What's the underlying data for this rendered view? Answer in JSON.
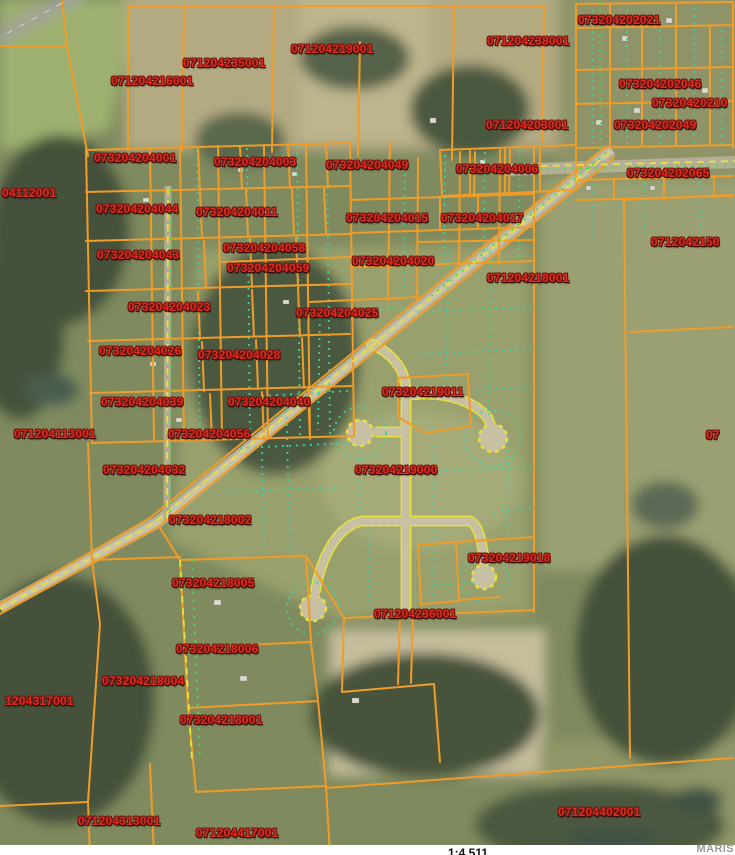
{
  "map": {
    "type": "gis-parcel-aerial-map",
    "scale_text": "1:4,511",
    "watermark": "MARIS",
    "colors": {
      "parcel_line": "#f09c28",
      "parcel_label": "#e12a1e",
      "road_centerline": "#e8e23a",
      "lot_line": "#3bd3a0",
      "street_dots": "#3fe04a",
      "scale_text": "#111111",
      "watermark": "#98989a"
    },
    "parcel_labels": [
      {
        "id": "073204202021",
        "x": 578,
        "y": 13
      },
      {
        "id": "071204238001",
        "x": 487,
        "y": 34
      },
      {
        "id": "071204219001",
        "x": 291,
        "y": 42
      },
      {
        "id": "071204235001",
        "x": 183,
        "y": 56
      },
      {
        "id": "071204216001",
        "x": 111,
        "y": 74
      },
      {
        "id": "073204202046",
        "x": 619,
        "y": 77
      },
      {
        "id": "07320420210",
        "x": 652,
        "y": 96
      },
      {
        "id": "071204203001",
        "x": 486,
        "y": 118
      },
      {
        "id": "073204202049",
        "x": 614,
        "y": 118
      },
      {
        "id": "073204204001",
        "x": 94,
        "y": 151
      },
      {
        "id": "073204204003",
        "x": 214,
        "y": 155
      },
      {
        "id": "073204204049",
        "x": 326,
        "y": 158
      },
      {
        "id": "073204204006",
        "x": 456,
        "y": 162
      },
      {
        "id": "073204202065",
        "x": 627,
        "y": 166
      },
      {
        "id": "04112001",
        "x": 2,
        "y": 186
      },
      {
        "id": "073204204044",
        "x": 96,
        "y": 202
      },
      {
        "id": "073204204011",
        "x": 196,
        "y": 205
      },
      {
        "id": "073204204015",
        "x": 346,
        "y": 211
      },
      {
        "id": "073204204017",
        "x": 441,
        "y": 211
      },
      {
        "id": "0712042150",
        "x": 651,
        "y": 235
      },
      {
        "id": "073204204058",
        "x": 223,
        "y": 241
      },
      {
        "id": "073204204043",
        "x": 97,
        "y": 248
      },
      {
        "id": "073204204020",
        "x": 352,
        "y": 254
      },
      {
        "id": "073204204059",
        "x": 227,
        "y": 261
      },
      {
        "id": "071204218001",
        "x": 487,
        "y": 271
      },
      {
        "id": "073204204023",
        "x": 128,
        "y": 300
      },
      {
        "id": "073204204025",
        "x": 296,
        "y": 306
      },
      {
        "id": "073204204026",
        "x": 99,
        "y": 344
      },
      {
        "id": "073204204028",
        "x": 198,
        "y": 348
      },
      {
        "id": "073204219011",
        "x": 382,
        "y": 385
      },
      {
        "id": "073204204039",
        "x": 101,
        "y": 395
      },
      {
        "id": "073204204040",
        "x": 228,
        "y": 395
      },
      {
        "id": "071204113001",
        "x": 14,
        "y": 427
      },
      {
        "id": "073204204056",
        "x": 168,
        "y": 427
      },
      {
        "id": "07",
        "x": 706,
        "y": 428
      },
      {
        "id": "073204204032",
        "x": 103,
        "y": 463
      },
      {
        "id": "073204219000",
        "x": 355,
        "y": 463
      },
      {
        "id": "073204218002",
        "x": 169,
        "y": 513
      },
      {
        "id": "073204219018",
        "x": 468,
        "y": 551
      },
      {
        "id": "073204218005",
        "x": 172,
        "y": 576
      },
      {
        "id": "071204236001",
        "x": 374,
        "y": 607
      },
      {
        "id": "073204218006",
        "x": 176,
        "y": 642
      },
      {
        "id": "073204218004",
        "x": 102,
        "y": 674
      },
      {
        "id": "1204317001",
        "x": 5,
        "y": 694
      },
      {
        "id": "073204218001",
        "x": 180,
        "y": 713
      },
      {
        "id": "071204402001",
        "x": 558,
        "y": 805
      },
      {
        "id": "071204313001",
        "x": 78,
        "y": 814
      },
      {
        "id": "071204417001",
        "x": 196,
        "y": 826
      }
    ]
  }
}
